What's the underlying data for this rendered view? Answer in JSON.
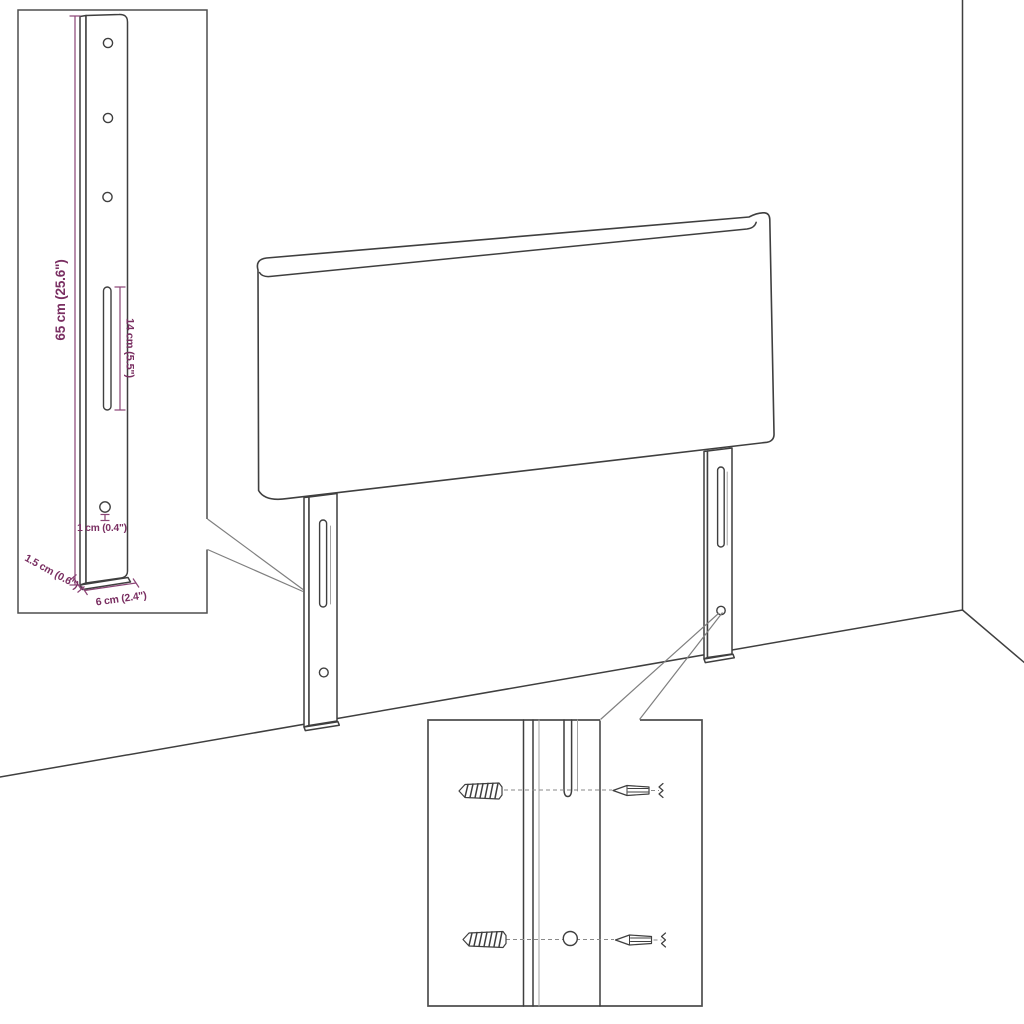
{
  "diagram_type": "headboard-mounting-technical-drawing",
  "inset": {
    "height_label": "65 cm (25.6\")",
    "slot_label": "14 cm (5.5\")",
    "hole_label": "1 cm (0.4\")",
    "depth_label": "1.5 cm (0.6\")",
    "width_label": "6 cm (2.4\")"
  },
  "icons": {
    "wall_plug": "wall-plug-icon",
    "screw": "screw-icon"
  },
  "colors": {
    "dimension_text": "#7a2f62",
    "dimension_line": "#8a4475",
    "outline": "#3f3f3f",
    "callout": "#7f7f7f",
    "background": "#ffffff"
  }
}
